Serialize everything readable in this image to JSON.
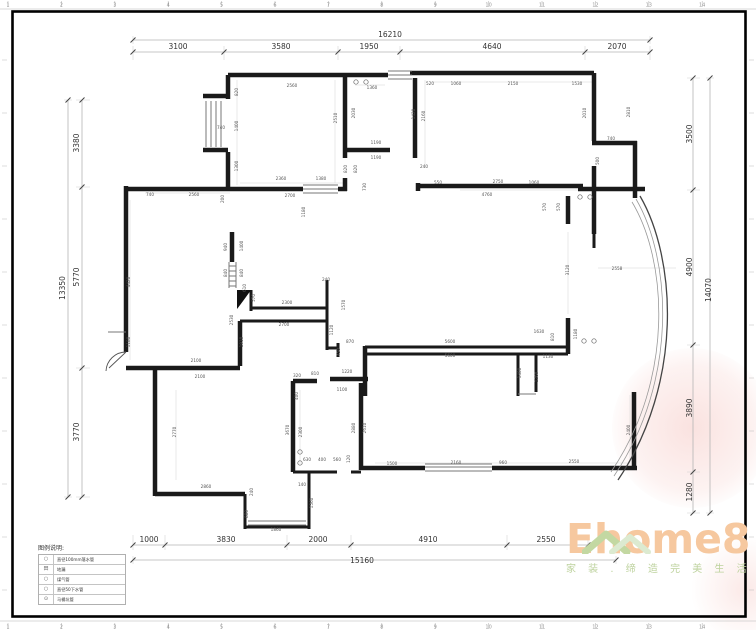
{
  "rulers": {
    "top": [
      "1",
      "2",
      "3",
      "4",
      "5",
      "6",
      "7",
      "8",
      "9",
      "10",
      "11",
      "12",
      "13",
      "14"
    ],
    "bottom": [
      "1",
      "2",
      "3",
      "4",
      "5",
      "6",
      "7",
      "8",
      "9",
      "10",
      "11",
      "12",
      "13",
      "14"
    ]
  },
  "legend": {
    "title": "图例说明:",
    "items": [
      {
        "symbol": "○",
        "label": "直径100mm落水管"
      },
      {
        "symbol": "田",
        "label": "地漏"
      },
      {
        "symbol": "○",
        "label": "煤气管"
      },
      {
        "symbol": "○",
        "label": "直径50下水管"
      },
      {
        "symbol": "⊙",
        "label": "马桶坑管"
      }
    ]
  },
  "logo": {
    "name": "Ehome8",
    "slogan": "家 装 . 缔 造 完 美 生 活",
    "accent_orange": "#f6c89f",
    "accent_green": "#bdd29d"
  },
  "dim_labels": [
    {
      "t": "16210",
      "x": 390,
      "y": 37,
      "s": 1
    },
    {
      "t": "3100",
      "x": 178,
      "y": 49,
      "s": 1
    },
    {
      "t": "3580",
      "x": 281,
      "y": 49,
      "s": 1
    },
    {
      "t": "1950",
      "x": 369,
      "y": 49,
      "s": 1
    },
    {
      "t": "4640",
      "x": 492,
      "y": 49,
      "s": 1
    },
    {
      "t": "2070",
      "x": 617,
      "y": 49,
      "s": 1
    },
    {
      "t": "13350",
      "x": 65,
      "y": 288,
      "r": -90,
      "s": 1
    },
    {
      "t": "3380",
      "x": 79,
      "y": 143,
      "r": -90,
      "s": 1
    },
    {
      "t": "5770",
      "x": 79,
      "y": 277,
      "r": -90,
      "s": 1
    },
    {
      "t": "3770",
      "x": 79,
      "y": 432,
      "r": -90,
      "s": 1
    },
    {
      "t": "14070",
      "x": 711,
      "y": 290,
      "r": -90,
      "s": 1
    },
    {
      "t": "3500",
      "x": 692,
      "y": 134,
      "r": -90,
      "s": 1
    },
    {
      "t": "4900",
      "x": 692,
      "y": 267,
      "r": -90,
      "s": 1
    },
    {
      "t": "3890",
      "x": 692,
      "y": 408,
      "r": -90,
      "s": 1
    },
    {
      "t": "1280",
      "x": 692,
      "y": 492,
      "r": -90,
      "s": 1
    },
    {
      "t": "15160",
      "x": 362,
      "y": 563,
      "s": 1
    },
    {
      "t": "1000",
      "x": 149,
      "y": 542,
      "s": 1
    },
    {
      "t": "3830",
      "x": 226,
      "y": 542,
      "s": 1
    },
    {
      "t": "2000",
      "x": 318,
      "y": 542,
      "s": 1
    },
    {
      "t": "4910",
      "x": 428,
      "y": 542,
      "s": 1
    },
    {
      "t": "2550",
      "x": 546,
      "y": 542,
      "s": 1
    },
    {
      "t": "2560",
      "x": 292,
      "y": 87
    },
    {
      "t": "820",
      "x": 238,
      "y": 92,
      "r": -90
    },
    {
      "t": "1400",
      "x": 238,
      "y": 126,
      "r": -90
    },
    {
      "t": "740",
      "x": 221,
      "y": 129
    },
    {
      "t": "1300",
      "x": 238,
      "y": 166,
      "r": -90
    },
    {
      "t": "2510",
      "x": 337,
      "y": 118,
      "r": -90
    },
    {
      "t": "2360",
      "x": 281,
      "y": 180
    },
    {
      "t": "1380",
      "x": 321,
      "y": 180
    },
    {
      "t": "2700",
      "x": 290,
      "y": 197
    },
    {
      "t": "740",
      "x": 150,
      "y": 196
    },
    {
      "t": "2560",
      "x": 194,
      "y": 196
    },
    {
      "t": "200",
      "x": 224,
      "y": 199,
      "r": -90
    },
    {
      "t": "1180",
      "x": 305,
      "y": 212,
      "r": -90
    },
    {
      "t": "4420",
      "x": 130,
      "y": 282,
      "r": -90
    },
    {
      "t": "1180",
      "x": 130,
      "y": 342,
      "r": -90
    },
    {
      "t": "2100",
      "x": 196,
      "y": 362
    },
    {
      "t": "2100",
      "x": 200,
      "y": 378
    },
    {
      "t": "1360",
      "x": 372,
      "y": 89
    },
    {
      "t": "2030",
      "x": 355,
      "y": 113,
      "r": -90
    },
    {
      "t": "1190",
      "x": 376,
      "y": 144
    },
    {
      "t": "1190",
      "x": 376,
      "y": 159
    },
    {
      "t": "820",
      "x": 347,
      "y": 169,
      "r": -90
    },
    {
      "t": "820",
      "x": 357,
      "y": 169,
      "r": -90
    },
    {
      "t": "730",
      "x": 366,
      "y": 187,
      "r": -90
    },
    {
      "t": "520",
      "x": 430,
      "y": 85
    },
    {
      "t": "1060",
      "x": 456,
      "y": 85
    },
    {
      "t": "2150",
      "x": 513,
      "y": 85
    },
    {
      "t": "1530",
      "x": 577,
      "y": 85
    },
    {
      "t": "1420",
      "x": 415,
      "y": 114,
      "r": -90
    },
    {
      "t": "2160",
      "x": 425,
      "y": 116,
      "r": -90
    },
    {
      "t": "2010",
      "x": 586,
      "y": 113,
      "r": -90
    },
    {
      "t": "2810",
      "x": 630,
      "y": 112,
      "r": -90
    },
    {
      "t": "740",
      "x": 611,
      "y": 140
    },
    {
      "t": "500",
      "x": 599,
      "y": 161,
      "r": -90
    },
    {
      "t": "240",
      "x": 424,
      "y": 168
    },
    {
      "t": "550",
      "x": 438,
      "y": 184
    },
    {
      "t": "2750",
      "x": 498,
      "y": 183
    },
    {
      "t": "1060",
      "x": 534,
      "y": 184
    },
    {
      "t": "4760",
      "x": 487,
      "y": 196
    },
    {
      "t": "570",
      "x": 546,
      "y": 207,
      "r": -90
    },
    {
      "t": "570",
      "x": 560,
      "y": 207,
      "r": -90
    },
    {
      "t": "940",
      "x": 227,
      "y": 247,
      "r": -90
    },
    {
      "t": "1400",
      "x": 243,
      "y": 246,
      "r": -90
    },
    {
      "t": "840",
      "x": 227,
      "y": 273,
      "r": -90
    },
    {
      "t": "840",
      "x": 243,
      "y": 273,
      "r": -90
    },
    {
      "t": "610",
      "x": 246,
      "y": 288,
      "r": -90
    },
    {
      "t": "240",
      "x": 326,
      "y": 281
    },
    {
      "t": "2300",
      "x": 287,
      "y": 304
    },
    {
      "t": "570",
      "x": 255,
      "y": 298,
      "r": -90
    },
    {
      "t": "2700",
      "x": 284,
      "y": 326
    },
    {
      "t": "2530",
      "x": 233,
      "y": 320,
      "r": -90
    },
    {
      "t": "1910",
      "x": 243,
      "y": 342,
      "r": -90
    },
    {
      "t": "1120",
      "x": 333,
      "y": 330,
      "r": -90
    },
    {
      "t": "870",
      "x": 350,
      "y": 343
    },
    {
      "t": "450",
      "x": 340,
      "y": 352,
      "r": -90
    },
    {
      "t": "1570",
      "x": 345,
      "y": 305,
      "r": -90
    },
    {
      "t": "3120",
      "x": 569,
      "y": 270,
      "r": -90
    },
    {
      "t": "2558",
      "x": 617,
      "y": 270
    },
    {
      "t": "5600",
      "x": 450,
      "y": 343
    },
    {
      "t": "5600",
      "x": 450,
      "y": 357
    },
    {
      "t": "1630",
      "x": 539,
      "y": 333
    },
    {
      "t": "810",
      "x": 554,
      "y": 337,
      "r": -90
    },
    {
      "t": "1180",
      "x": 577,
      "y": 334,
      "r": -90
    },
    {
      "t": "1130",
      "x": 548,
      "y": 358
    },
    {
      "t": "1400",
      "x": 521,
      "y": 373,
      "r": -90
    },
    {
      "t": "1260",
      "x": 538,
      "y": 377,
      "r": -90
    },
    {
      "t": "2400",
      "x": 630,
      "y": 430,
      "r": -90
    },
    {
      "t": "2770",
      "x": 176,
      "y": 432,
      "r": -90
    },
    {
      "t": "2860",
      "x": 206,
      "y": 488
    },
    {
      "t": "240",
      "x": 253,
      "y": 492,
      "r": -90
    },
    {
      "t": "880",
      "x": 248,
      "y": 514,
      "r": -90
    },
    {
      "t": "1860",
      "x": 276,
      "y": 531
    },
    {
      "t": "1560",
      "x": 313,
      "y": 503,
      "r": -90
    },
    {
      "t": "140",
      "x": 302,
      "y": 486
    },
    {
      "t": "320",
      "x": 297,
      "y": 377
    },
    {
      "t": "810",
      "x": 315,
      "y": 375
    },
    {
      "t": "1220",
      "x": 347,
      "y": 373
    },
    {
      "t": "1100",
      "x": 342,
      "y": 391
    },
    {
      "t": "400",
      "x": 298,
      "y": 396,
      "r": -90
    },
    {
      "t": "3670",
      "x": 289,
      "y": 430,
      "r": -90
    },
    {
      "t": "2300",
      "x": 302,
      "y": 432,
      "r": -90
    },
    {
      "t": "2880",
      "x": 355,
      "y": 428,
      "r": -90
    },
    {
      "t": "2610",
      "x": 366,
      "y": 428,
      "r": -90
    },
    {
      "t": "630",
      "x": 307,
      "y": 461
    },
    {
      "t": "400",
      "x": 322,
      "y": 461
    },
    {
      "t": "560",
      "x": 337,
      "y": 461
    },
    {
      "t": "120",
      "x": 350,
      "y": 459,
      "r": -90
    },
    {
      "t": "1500",
      "x": 392,
      "y": 465
    },
    {
      "t": "2160",
      "x": 456,
      "y": 464
    },
    {
      "t": "960",
      "x": 503,
      "y": 464
    },
    {
      "t": "2550",
      "x": 574,
      "y": 463
    }
  ],
  "symbols": [
    {
      "x": 356,
      "y": 82
    },
    {
      "x": 366,
      "y": 82
    },
    {
      "x": 580,
      "y": 197
    },
    {
      "x": 590,
      "y": 197
    },
    {
      "x": 300,
      "y": 452
    },
    {
      "x": 300,
      "y": 463
    },
    {
      "x": 584,
      "y": 341
    },
    {
      "x": 594,
      "y": 341
    }
  ]
}
